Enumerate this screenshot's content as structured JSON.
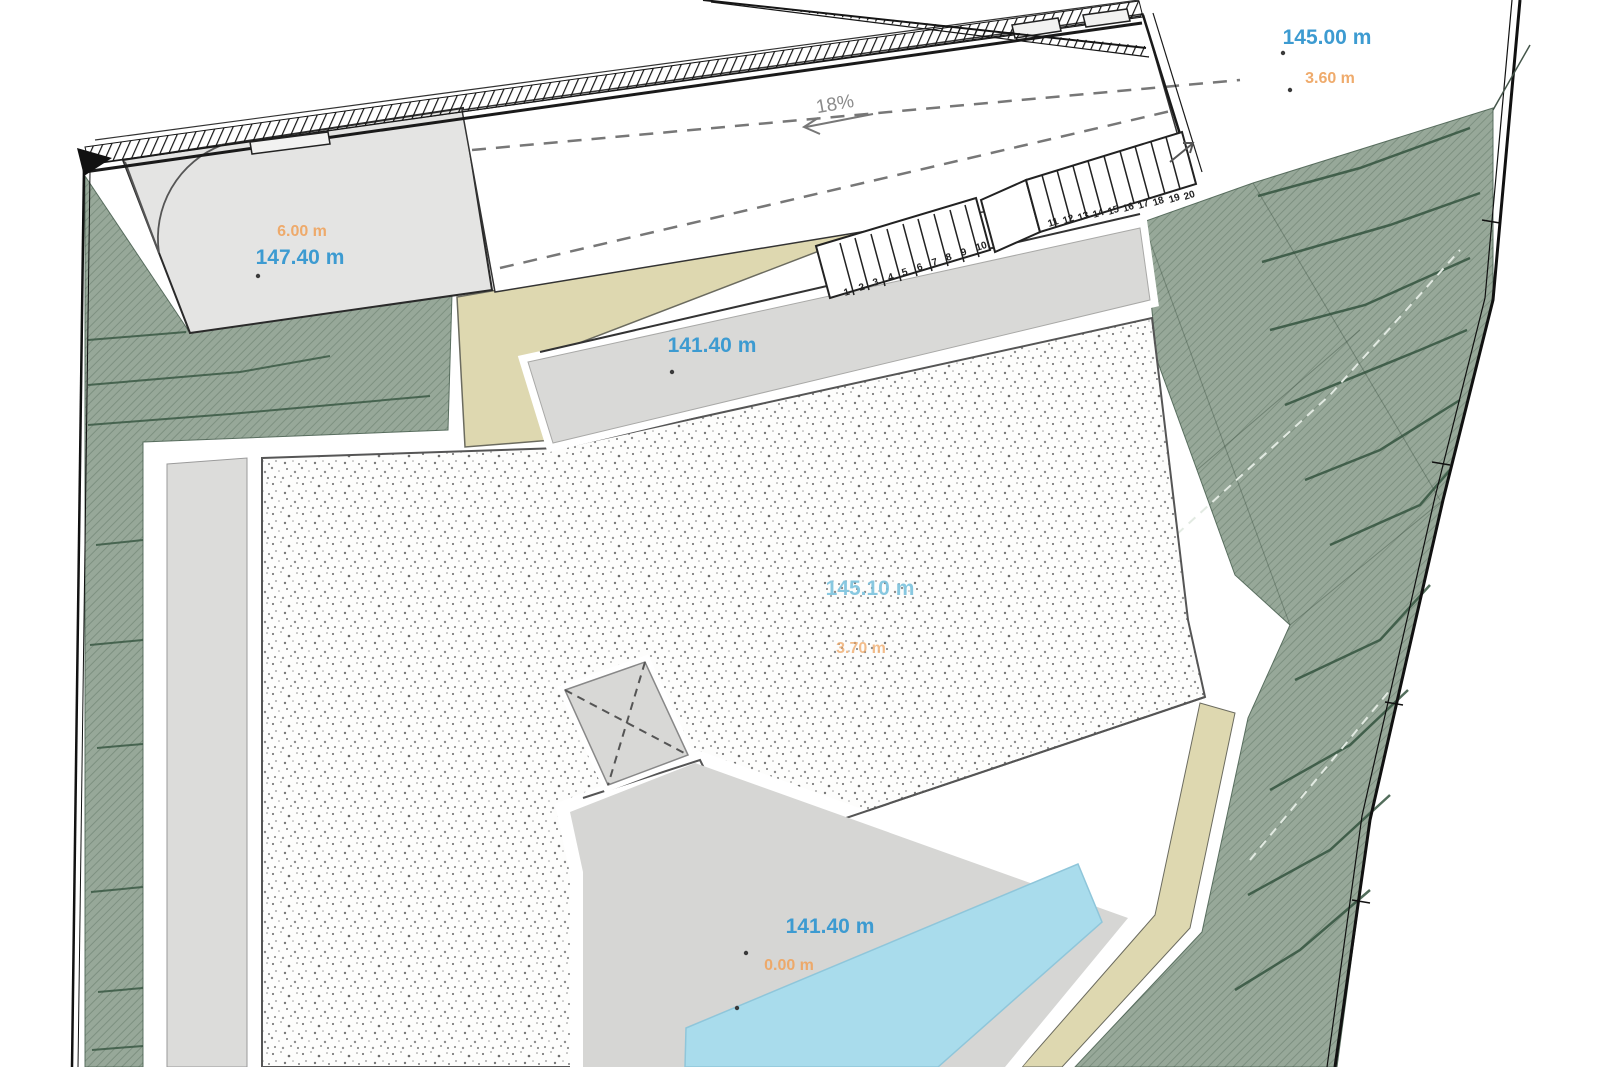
{
  "drawing": {
    "kind": "architectural site plan",
    "labels": {
      "street_elevation": "145.00 m",
      "street_depth": "3.60 m",
      "driveway_height": "6.00 m",
      "driveway_elevation": "147.40 m",
      "ramp_slope": "18%",
      "walkway_elevation": "141.40 m",
      "roof_elevation": "145.10 m",
      "roof_depth": "3.70 m",
      "courtyard_elevation": "141.40 m",
      "courtyard_depth": "0.00 m"
    },
    "stairs": {
      "numbers": [
        "1",
        "2",
        "3",
        "4",
        "5",
        "6",
        "7",
        "8",
        "9",
        "10",
        "11",
        "12",
        "13",
        "14",
        "15",
        "16",
        "17",
        "18",
        "19",
        "20"
      ]
    },
    "colors": {
      "elevation_label": "#3d9bd1",
      "depth_label": "#efa765",
      "slope_label": "#8a8a8a",
      "terrain_green": "#97a899",
      "path_beige": "#ded8b0",
      "pool_blue": "#a9dcec",
      "surface_gray": "#d6d6d4",
      "stipple_roof": "#fdfdfc"
    }
  }
}
